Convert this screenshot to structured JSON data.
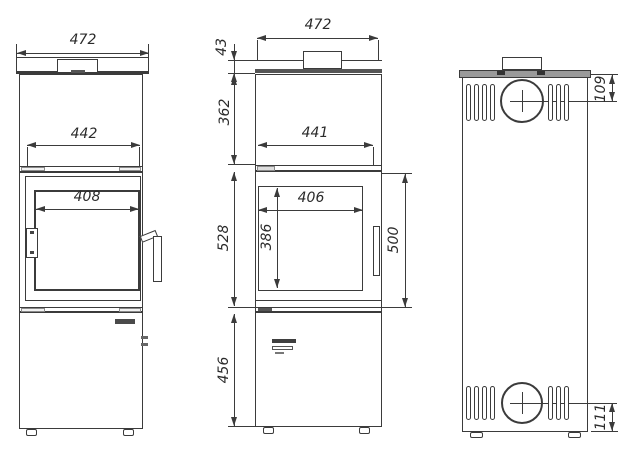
{
  "drawing_title": "stove-three-view-dimension-drawing",
  "dims": {
    "front_width": "472",
    "front_inner_width": "442",
    "front_glass_width": "408",
    "section_width": "472",
    "section_top_height": "43",
    "section_upper_height": "362",
    "section_inner_width": "441",
    "section_firebox_width": "406",
    "section_glass_height": "386",
    "section_firebox_height": "528",
    "section_door_span": "500",
    "section_base_height": "456",
    "back_flue_top_offset": "109",
    "back_flue_bottom_offset": "111"
  },
  "colors": {
    "line": "#3b3b3b",
    "text": "#2b2b2b",
    "cap_fill": "#9a9a9a"
  }
}
